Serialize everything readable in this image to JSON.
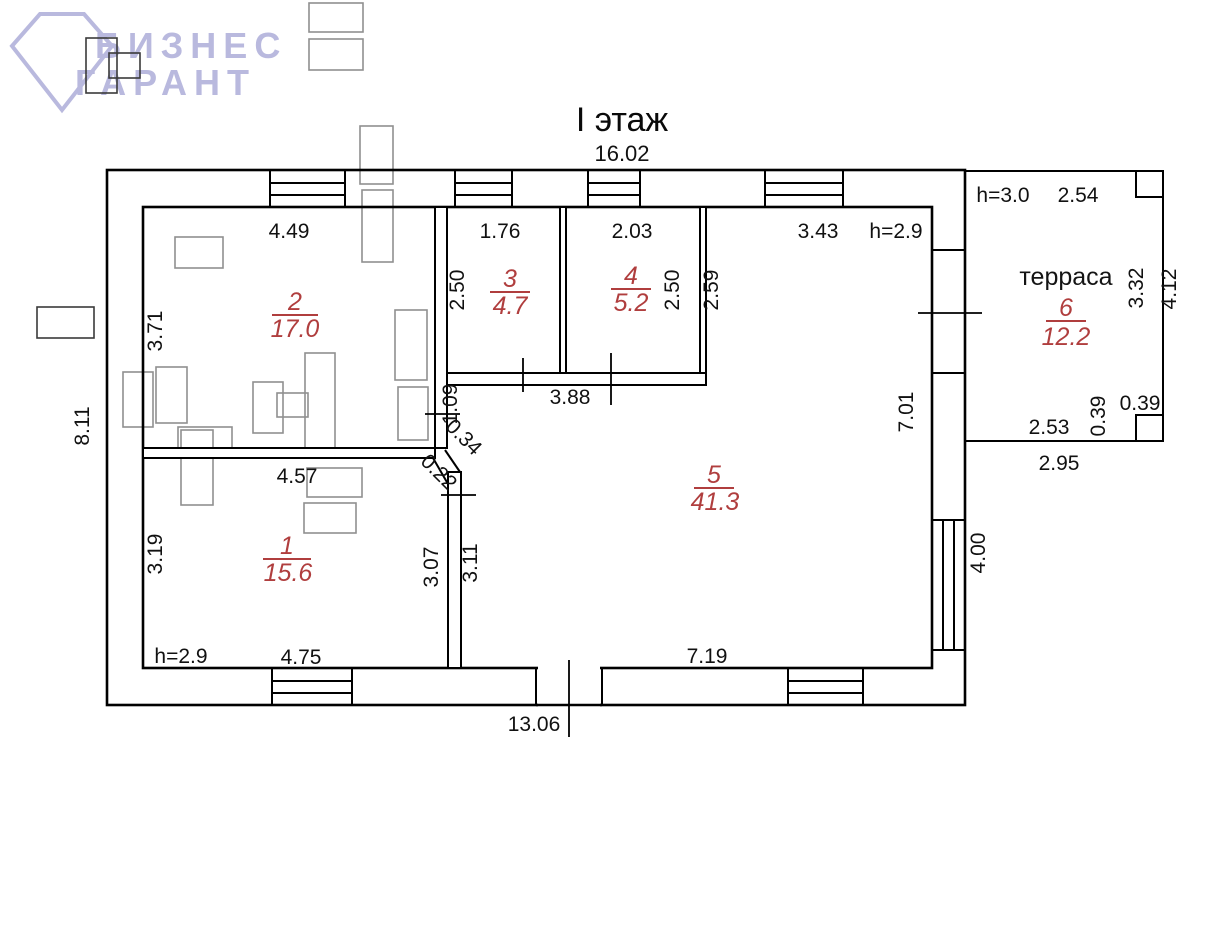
{
  "logo": {
    "line1": "БИЗНЕС",
    "line2": "ГАРАНТ"
  },
  "title": {
    "floor": "I этаж"
  },
  "colors": {
    "room_label": "#b03e3e",
    "wall": "#000000",
    "furniture": "#8f8f8f",
    "logo": "#b9b9de",
    "background": "#ffffff"
  },
  "rooms": [
    {
      "number": "1",
      "area": "15.6"
    },
    {
      "number": "2",
      "area": "17.0"
    },
    {
      "number": "3",
      "area": "4.7"
    },
    {
      "number": "4",
      "area": "5.2"
    },
    {
      "number": "5",
      "area": "41.3"
    },
    {
      "number": "6",
      "area": "12.2",
      "name": "терраса"
    }
  ],
  "dims": {
    "top_total": "16.02",
    "bottom_total": "13.06",
    "left_total": "8.11",
    "room2_w": "4.49",
    "room2_h": "3.71",
    "room3_w": "1.76",
    "room3_h": "2.50",
    "room4_w": "2.03",
    "room4_h": "2.50",
    "corridor_h": "2.59",
    "top_right_w": "3.43",
    "height_main": "h=2.9",
    "terrace_height_note": "h=3.0",
    "terrace_top_w": "2.54",
    "terrace_inner_h": "3.32",
    "terrace_outer_h": "4.12",
    "pillar_h": "0.39",
    "pillar_w": "0.39",
    "terrace_bottom_inner": "2.53",
    "terrace_bottom_outer": "2.95",
    "rooms34_w": "3.88",
    "room5_h": "7.01",
    "niche": "1.09",
    "chamfer_a": "0.34",
    "chamfer_b": "0.22",
    "room1_w": "4.57",
    "room1_h": "3.19",
    "room1_right_h": "3.07",
    "room5_left_h": "3.11",
    "window_right": "4.00",
    "room1_height_note": "h=2.9",
    "room1_bottom_w": "4.75",
    "room5_bottom_w": "7.19"
  }
}
